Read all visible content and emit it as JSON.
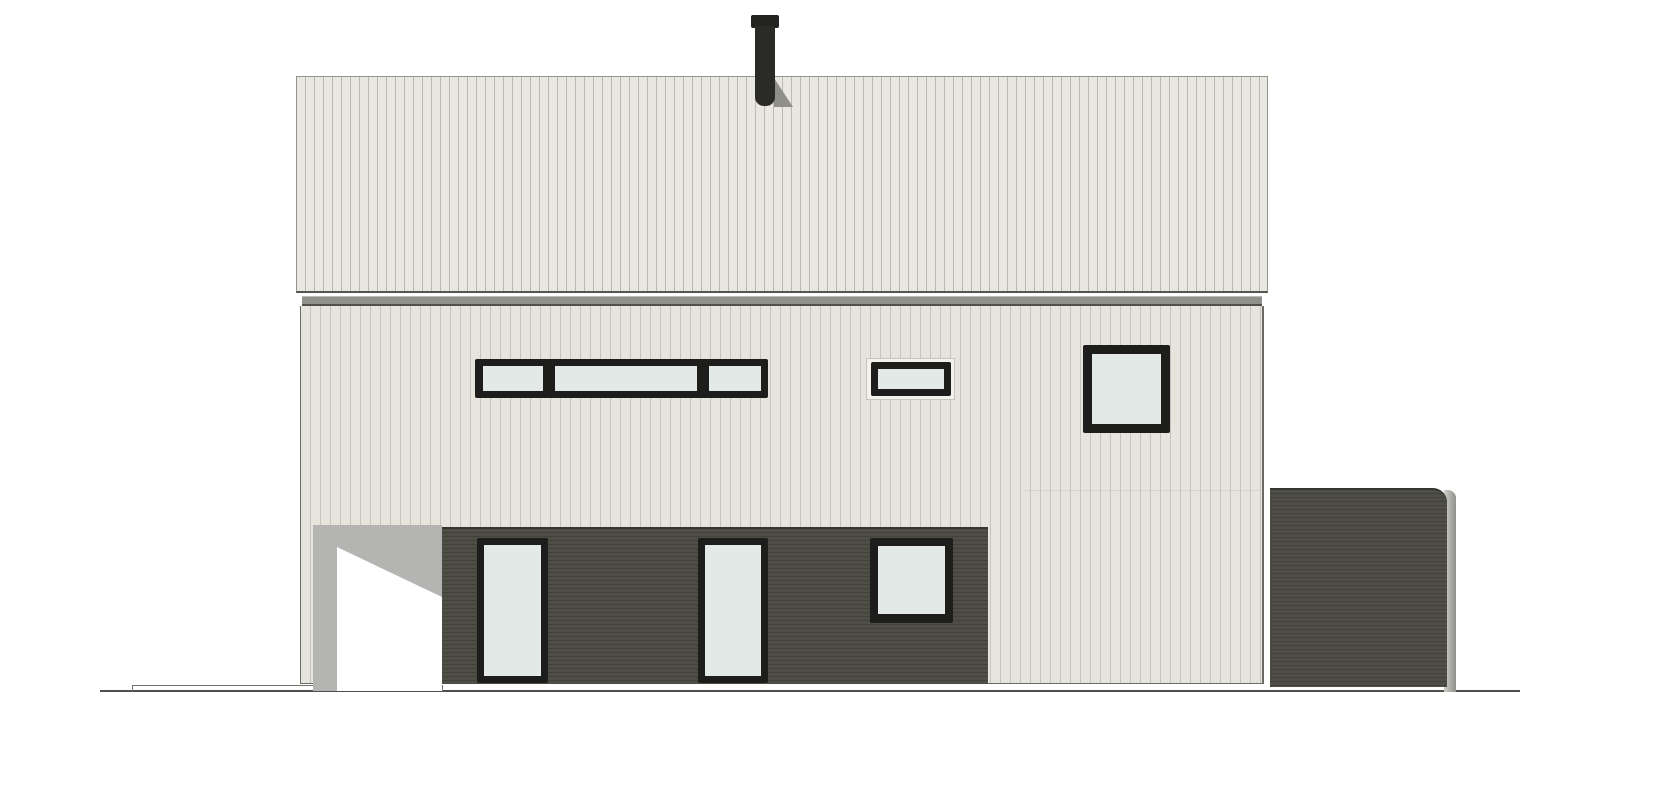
{
  "drawing": {
    "type": "house-elevation"
  },
  "colors": {
    "white": "#ffffff",
    "siding_light": "#e9e7e0",
    "siding_stripe": "#bab8af",
    "wall_light": "#e6e4dd",
    "wall_stripe": "#c6c4bb",
    "dark_hi": "#4e4e46",
    "dark_lo": "#42423b",
    "frame_black": "#1d1d1b",
    "glass": "#e3e9e6",
    "trim_gray": "#90908a",
    "trim_gray_light": "#bcbcb7",
    "trim_gray_dark": "#504f4a",
    "shadow_gray": "#b4b4b2",
    "chimney": "#2a2a27",
    "chimney_cap": "#232321",
    "chimney_shadow": "#8f8f89",
    "terrain": "#50504b",
    "outline": "#6b6b65",
    "band_edge": "#93938d",
    "band_edge_dark": "#54544e",
    "dark_top_edge": "#35352f",
    "annex_edge_hi": "#cfcfcb",
    "annex_edge_lo": "#8f8f8b",
    "small_window_trim": "#f2f1eb",
    "small_window_trim_edge": "#c6c4bd",
    "seam": "#d2d0c9",
    "platform_line": "#71716b"
  },
  "components": {
    "chimney_count": 1,
    "strip_window_pane_count": 3,
    "small_horizontal_window_count": 1,
    "upper_square_window_count": 1,
    "base_square_window_count": 1,
    "tall_glass_door_count": 2,
    "annex_count": 1,
    "carport_recess_count": 1
  }
}
